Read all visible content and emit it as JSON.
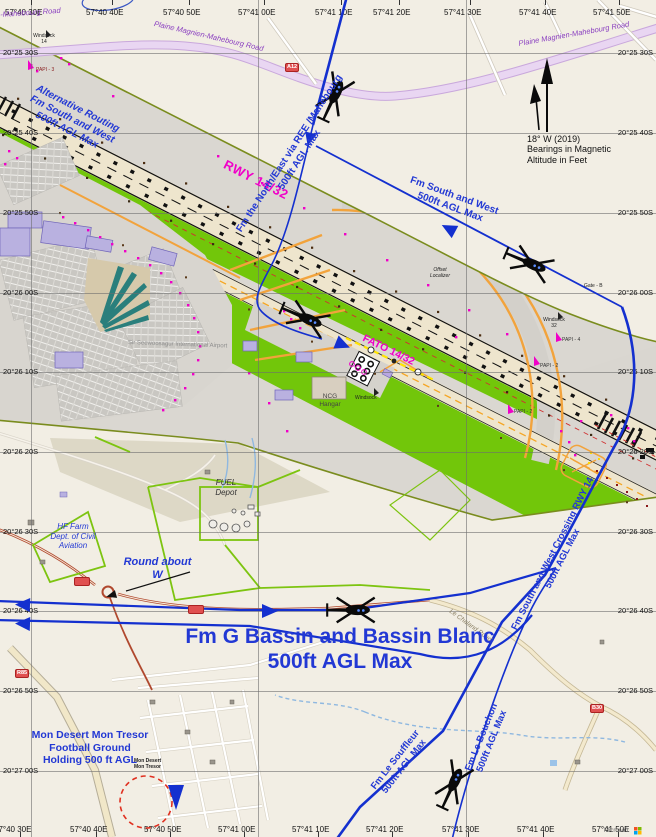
{
  "grid": {
    "top": [
      "57°40 30E",
      "57°40 40E",
      "57°40 50E",
      "57°41 00E",
      "57°41 10E",
      "57°41 20E",
      "57°41 30E",
      "57°41 40E",
      "57°41 50E"
    ],
    "bottom": [
      "57°40 30E",
      "57°40 40E",
      "57°40 50E",
      "57°41 00E",
      "57°41 10E",
      "57°41 20E",
      "57°41 30E",
      "57°41 40E",
      "57°41 50E"
    ],
    "left": [
      "20°25 30S",
      "20°25 40S",
      "20°25 50S",
      "20°26 00S",
      "20°26 10S",
      "20°26 20S",
      "20°26 30S",
      "20°26 40S",
      "20°26 50S",
      "20°27 00S"
    ],
    "right": [
      "20°25 30S",
      "20°25 40S",
      "20°25 50S",
      "20°26 00S",
      "20°26 10S",
      "20°26 20S",
      "20°26 30S",
      "20°26 40S",
      "20°26 50S",
      "20°27 00S"
    ]
  },
  "roads": {
    "plaine_magnien_1": "Plaine Magnien-Mahebourg Road",
    "plaine_magnien_2": "Plaine Magnien-Mahebourg Road",
    "mahebourg_partial": "-Mahebourg Road",
    "le_chaland": "Le Chaland Road",
    "badge_a12": "A12",
    "badge_b30": "B30",
    "badge_r85": "R85"
  },
  "airport": {
    "rwy_label": "RWY 14/32",
    "fato_label": "FATO 14/32",
    "name_label": "Sir Seewoosagur International Airport",
    "ncg_line1": "NCG",
    "ncg_line2": "Hangar",
    "windsock_14_line1": "Windsock",
    "windsock_14_line2": "14",
    "windsock_32_line1": "Windsock",
    "windsock_32_line2": "32",
    "windsock_center": "Windsock",
    "offset_localizer_line1": "Offset",
    "offset_localizer_line2": "Localizer",
    "gate_b": "Gate - B",
    "papi_3": "PAPI - 3",
    "papi_4": "PAPI - 4",
    "papi_2a": "PAPI - 2",
    "papi_2b": "PAPI - 2",
    "fuel_line1": "FUEL",
    "fuel_line2": "Depot",
    "hf_line1": "HF Farm",
    "hf_line2": "Dept. of Civil",
    "hf_line3": "Aviation"
  },
  "routes": {
    "north_line1": "Fm the North/East via  REE /Mahebourg",
    "north_line2": "500ft AGL Max",
    "alt_line1": "Alternative Routing",
    "alt_line2": "Fm South and West",
    "alt_line3": "500ft AGL Max",
    "sw_line1": "Fm South and West",
    "sw_line2": "500ft AGL Max",
    "bassin_line1": "Fm G Bassin and Bassin Blanc",
    "bassin_line2": "500ft AGL Max",
    "crossing_line1": "Fm South and West Crossing RWY 14",
    "crossing_line2": "500ft AGL Max",
    "souffleur_line1": "Fm Le Souffleur",
    "souffleur_line2": "500ft AGL Max",
    "bouchon_line1": "Fm Le Bouchon",
    "bouchon_line2": "500ft AGL Max",
    "roundabout_line1": "Round about",
    "roundabout_line2": "W",
    "holding_line1": "Mon Desert Mon Tresor",
    "holding_line2": "Football Ground",
    "holding_line3": "Holding 500 ft AGL"
  },
  "legend": {
    "magnetic_line1": "18° W (2019)",
    "magnetic_line2": "Bearings in Magnetic",
    "magnetic_line3": "Altitude in Feet"
  },
  "places": {
    "mon_desert_line1": "Mon Desert",
    "mon_desert_line2": "Mon Tresor"
  },
  "attribution": "Microsoft",
  "colors": {
    "route_blue": "#1430cf",
    "annotation_blue": "#2238d4",
    "magenta": "#f000c8",
    "grass_green": "#72c60a",
    "apron_gray": "#d9d6d0",
    "road_lavender": "#e7d3f0"
  }
}
